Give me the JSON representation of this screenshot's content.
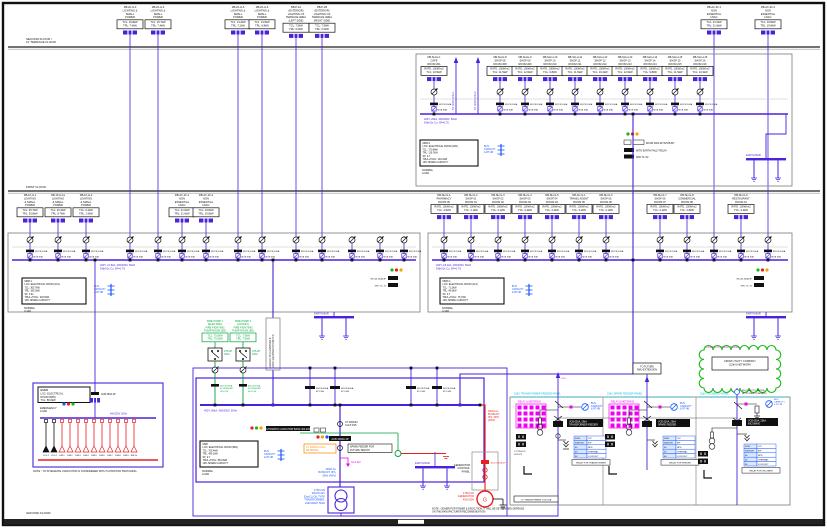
{
  "floors": {
    "second": [
      "SECOND FLOOR /",
      "1F TERRACE FLOOR"
    ],
    "first": [
      "FIRST FLOOR"
    ],
    "ground": [
      "GROUND FLOOR"
    ]
  },
  "shared": {
    "normal_load": [
      "NORMAL",
      "LOAD"
    ],
    "emergency_load": [
      "EMERGENCY",
      "LOAD"
    ],
    "capacity": [
      "BUS",
      "CAPACITY",
      "& RT-4B"
    ],
    "earth_bar": "EARTH BAR",
    "mcb_label": "MCB 63A",
    "chip_label": "MCCB 100A",
    "pilot": "R-Y-B"
  },
  "top_feeders": {
    "items": [
      {
        "x": 130,
        "lines": [
          "DB-2F-H-3",
          "LIGHTING &",
          "SMALL",
          "POWER"
        ],
        "box": [
          "TCL: 16.8kW",
          "TRL: 7.4kW"
        ]
      },
      {
        "x": 158,
        "lines": [
          "DB-2F-H-4",
          "LIGHTING &",
          "SMALL",
          "POWER"
        ],
        "box": [
          "TCL: 15.7kW",
          "TRL: 7.4kW"
        ]
      },
      {
        "x": 238,
        "lines": [
          "DB-2F-H-5",
          "LIGHTING &",
          "SMALL",
          "POWER"
        ],
        "box": [
          "TCL: 14.2kW",
          "TRL: 7.1kW"
        ]
      },
      {
        "x": 262,
        "lines": [
          "DB-2F-H-6",
          "LIGHTING &",
          "SMALL",
          "POWER"
        ],
        "box": [
          "TCL: 13.6kW",
          "TRL: 6.8kW"
        ]
      },
      {
        "x": 296,
        "lines": [
          "DB-P-1A",
          "(EXTERIOR)",
          "LIGHTING OF",
          "TERRACE AREA",
          "(LEFT SIDE)"
        ],
        "box": [
          "TCL: 7.5kW",
          "TRL: 6.0kW"
        ]
      },
      {
        "x": 322,
        "lines": [
          "DB-P-1B",
          "(EXTERIOR)",
          "LIGHTING OF",
          "TERRACE AREA",
          "(RIGHT SIDE)"
        ],
        "box": [
          "TCL: 7.5kW",
          "TRL: 6.0kW"
        ]
      },
      {
        "x": 714,
        "lines": [
          "DB-AC-2F-1",
          "NON",
          "ESSENTIAL",
          "HVAC"
        ],
        "box": [
          "TCL: 21.6kW",
          "TRL: 21.6kW"
        ]
      },
      {
        "x": 768,
        "lines": [
          "DB-AC-2F-2",
          "NON",
          "ESSENTIAL",
          "HVAC"
        ],
        "box": [
          "TCL: 19.8kW",
          "TRL: 19.8kW"
        ]
      }
    ]
  },
  "p2f": {
    "bus_note": [
      "400Y, 26kA, 400/230V, 50Hz",
      "63kA/1s Cu, SF=0.75"
    ],
    "info": [
      "MDB-2",
      "LOC: ELECTRICAL ROOM (206)",
      "TCL: 170.8kW",
      "TRL: 119.7kW",
      "SF: 0.7",
      "TRUL+TDCL: 149.2kW",
      "10% SPARE CAPACITY"
    ],
    "risers": [
      {
        "x": 456,
        "label": "TO ROOF AHU-1"
      },
      {
        "x": 478,
        "label": "TO ROOF AHU-2"
      }
    ],
    "notes": [
      "MCCB 400A 4P W/SHUNT",
      "WITH EARTH FAULT RELAY",
      "SPD T1+T2"
    ],
    "circuits": [
      {
        "x": 434,
        "lines": [
          "DB-SH-H-1",
          "CAFE",
          "ROOM 201"
        ],
        "box": [
          "RATE: 100W/m2",
          "TCL: 10.5kW"
        ]
      },
      {
        "x": 500,
        "lines": [
          "DB-SH-H-8",
          "SHOP 08",
          "ROOM 208"
        ],
        "box": [
          "RATE: 100W/m2",
          "TCL: 11.5kW"
        ]
      },
      {
        "x": 525,
        "lines": [
          "DB-SH-H-9",
          "SHOP 09",
          "ROOM 209"
        ],
        "box": [
          "RATE: 100W/m2",
          "TCL: 12.6kW"
        ]
      },
      {
        "x": 550,
        "lines": [
          "DB-SH-H-10",
          "SHOP 10",
          "ROOM 210"
        ],
        "box": [
          "RATE: 100W/m2",
          "TCL: 9.8kW"
        ]
      },
      {
        "x": 575,
        "lines": [
          "DB-SH-H-11",
          "SHOP 11",
          "ROOM 211"
        ],
        "box": [
          "RATE: 100W/m2",
          "TCL: 11.5kW"
        ]
      },
      {
        "x": 600,
        "lines": [
          "DB-SH-H-12",
          "SHOP 12",
          "ROOM 212"
        ],
        "box": [
          "RATE: 100W/m2",
          "TCL: 10.2kW"
        ]
      },
      {
        "x": 625,
        "lines": [
          "DB-SH-H-13",
          "SHOP 13",
          "ROOM 213"
        ],
        "box": [
          "RATE: 100W/m2",
          "TCL: 12.6kW"
        ]
      },
      {
        "x": 650,
        "lines": [
          "DB-SH-H-14",
          "SHOP 14",
          "ROOM 214"
        ],
        "box": [
          "RATE: 100W/m2",
          "TCL: 9.8kW"
        ]
      },
      {
        "x": 675,
        "lines": [
          "DB-SH-H-15",
          "SHOP 15",
          "ROOM 215"
        ],
        "box": [
          "RATE: 100W/m2",
          "TCL: 11.5kW"
        ]
      },
      {
        "x": 700,
        "lines": [
          "DB-SH-H-16",
          "SHOP 16",
          "ROOM 216"
        ],
        "box": [
          "RATE: 100W/m2",
          "TCL: 13.4kW"
        ]
      }
    ]
  },
  "p1fl": {
    "bus_note": [
      "400Y, 21.5kA, 400/230V, 50Hz",
      "63kA/1s Cu, SF=0.7S"
    ],
    "info": [
      "MDB-1",
      "LOC: ELECTRICAL ROOM (101)",
      "TCL: 305.7kW",
      "TRL: 185.3kW",
      "SF: 0.61",
      "TRUL+TDCL: 203.5kW",
      "10% SPARE CAPACITY"
    ],
    "notes": [
      "MCCB 400A 4P",
      "SPD T1+T2"
    ],
    "circuits": [
      {
        "x": 30,
        "lines": [
          "DB-1F-H-1",
          "LIGHTING",
          "& SMALL",
          "POWER"
        ],
        "box": [
          "TCL: 35.7kW",
          "TRL: 30.8kW"
        ]
      },
      {
        "x": 58,
        "lines": [
          "DB-1F-H-1a",
          "LIGHTING",
          "& SMALL",
          "POWER"
        ],
        "box": [
          "TCL: 26.3kW",
          "TRL: 8.7kW"
        ]
      },
      {
        "x": 86,
        "lines": [
          "DB-1F-H-2",
          "LIGHTING",
          "& SMALL",
          "POWER"
        ],
        "box": [
          "TCL: 6.2kW",
          "TRL: 1.5kW"
        ]
      },
      {
        "x": 130,
        "start": 226
      },
      {
        "x": 158,
        "start": 226
      },
      {
        "x": 182,
        "lines": [
          "DB-AC-1F-1",
          "NON",
          "ESSENTIAL",
          "HVAC"
        ],
        "box": [
          "TCL: 21.6kW",
          "TRL: 21.6kW"
        ]
      },
      {
        "x": 206,
        "lines": [
          "DB-AC-1F-2",
          "NON",
          "ESSENTIAL",
          "HVAC"
        ],
        "box": [
          "TCL: 19.8kW",
          "TRL: 19.8kW"
        ]
      },
      {
        "x": 238,
        "start": 226
      },
      {
        "x": 262,
        "start": 226
      },
      {
        "x": 296,
        "start": 226
      },
      {
        "x": 322,
        "start": 226
      },
      {
        "x": 352,
        "start": 236
      },
      {
        "x": 380,
        "start": 236
      },
      {
        "x": 404,
        "start": 236
      }
    ]
  },
  "p1fr": {
    "bus_note": [
      "400Y, 18.1kA, 400/230V, 50Hz",
      "63kA/1s Cu, SF=0.7S"
    ],
    "info": [
      "MDB-G",
      "LOC: ELECTRICAL ROOM (113)",
      "TCL: 71.3kW",
      "TRL: 49.9kW",
      "SF: 0.7",
      "TRUL+TDCL: 76.7kW",
      "10% SPARE CAPACITY"
    ],
    "notes": [
      "MCCB 400A 4P",
      "SPD T1+T2"
    ],
    "circuits": [
      {
        "x": 444,
        "lines": [
          "DB-SH-G-1",
          "PHARMACY",
          "ROOM 09"
        ],
        "box": [
          "RATE: 100W/m2",
          "TCL: 2.5kW"
        ]
      },
      {
        "x": 471,
        "lines": [
          "DB-SH-G-2",
          "SHOP 01",
          "ROOM 01"
        ],
        "box": [
          "RATE: 100W/m2",
          "TCL: 2.1kW"
        ]
      },
      {
        "x": 498,
        "lines": [
          "DB-SH-G-3",
          "SHOP 02",
          "ROOM 02"
        ],
        "box": [
          "RATE: 100W/m2",
          "TCL: 2.1kW"
        ]
      },
      {
        "x": 525,
        "lines": [
          "DB-SH-G-4",
          "SHOP 03",
          "ROOM 03"
        ],
        "box": [
          "RATE: 100W/m2",
          "TCL: 2.4kW"
        ]
      },
      {
        "x": 552,
        "lines": [
          "DB-SH-G-5",
          "SHOP 04",
          "ROOM 04"
        ],
        "box": [
          "RATE: 100W/m2",
          "TCL: 2.4kW"
        ]
      },
      {
        "x": 579,
        "lines": [
          "DB-AC-G-1",
          "TRAVEL AGENT",
          "ROOM 05"
        ],
        "box": [
          "RATE: 100W/m2",
          "TCL: 3.2kW"
        ]
      },
      {
        "x": 606,
        "lines": [
          "DB-SH-G-6",
          "SHOP 05",
          "ROOM 06"
        ],
        "box": [
          "RATE: 100W/m2",
          "TCL: 2.1kW"
        ]
      },
      {
        "x": 660,
        "lines": [
          "DB-SH-G-7",
          "SHOP 06",
          "ROOM 07"
        ],
        "box": [
          "RATE: 100W/m2",
          "TCL: 2.1kW"
        ]
      },
      {
        "x": 687,
        "lines": [
          "DB-SH-G-8",
          "COMMERCIAL",
          "ROOM 08"
        ],
        "box": [
          "RATE: 100W/m2",
          "TCL: 2.8kW"
        ]
      },
      {
        "x": 741,
        "lines": [
          "DB-SH-G-9",
          "RESTAURANT",
          "ROOM 10"
        ],
        "box": [
          "RATE: 100W/m2",
          "TCL: 3.4kW"
        ]
      },
      {
        "x": 714,
        "start": 226
      },
      {
        "x": 768,
        "start": 226
      }
    ]
  },
  "emdb": {
    "info": [
      "EMDB",
      "LOC: ELECTRICAL",
      "ROOM (B05)",
      "TCL: 86.6kW"
    ],
    "entry": "ACB 250A 4P",
    "bus_note": "400/230V, 50Hz",
    "note": "NOTE : TO INTEGRATE CAPACITOR IS CONSIDERED WITH THYRISTOR SWITCHING.",
    "branches": [
      {
        "x": 46,
        "label": "LTG-1",
        "color": "black"
      },
      {
        "x": 54,
        "label": "LTG-2",
        "color": "black"
      },
      {
        "x": 62,
        "label": "EM-1",
        "color": "red"
      },
      {
        "x": 70,
        "label": "EM-2",
        "color": "red"
      },
      {
        "x": 78,
        "label": "EM-3",
        "color": "red"
      },
      {
        "x": 86,
        "label": "EM-4",
        "color": "red"
      },
      {
        "x": 94,
        "label": "EM-5",
        "color": "red"
      },
      {
        "x": 102,
        "label": "EM-6",
        "color": "red"
      },
      {
        "x": 110,
        "label": "EM-7",
        "color": "red"
      },
      {
        "x": 118,
        "label": "EM-8",
        "color": "red"
      },
      {
        "x": 126,
        "label": "EM-9",
        "color": "red"
      },
      {
        "x": 134,
        "label": "EM-10",
        "color": "red"
      }
    ]
  },
  "msb": {
    "bus_note": "400Y, 65kA, 400/230V, 50Hz",
    "info": [
      "MSB",
      "LOC: ELECTRICAL ROOM (B01)",
      "TCL: 705.4kW",
      "TRL: 495.1kW",
      "SF: 0.7",
      "TRUL+TDCL: 581.8kW",
      "10% SPARE CAPACITY"
    ],
    "capbank": "AUTOMATIC CAPACITOR BANK 400 kVAr",
    "shaft_label": [
      "FEEDER TO ELEVATORS &",
      "ROOF EQUIPMENT (SHAFT 2)"
    ],
    "upfeeders": [
      {
        "x": 310,
        "label": [
          "MCCB 400A",
          "4P LSIG"
        ]
      },
      {
        "x": 335,
        "label": [
          "MCCB 400A",
          "4P LSIG"
        ]
      },
      {
        "x": 411,
        "label": [
          "MCCB 250A",
          "4P LSIG"
        ]
      },
      {
        "x": 437,
        "label": [
          "MCCB 250A",
          "4P LSIG"
        ]
      }
    ],
    "incomer": {
      "ct1": [
        "CT 2000/5A",
        "CL0.5 FS5"
      ],
      "acb": "ACB 4000A 4P",
      "ct2": [
        "CT 2000/5A CL0.2",
        "METERING"
      ],
      "spd": "SA 0.4kV",
      "busduct": [
        "3000A Cu",
        "BUSDUCT, 3Ph,",
        "50Hz (400V)"
      ]
    },
    "spare_box": [
      "SPARE FEEDER FOR",
      "FUTURE TENANT"
    ],
    "pumps": [
      {
        "x": 215,
        "lines": [
          "FIRE PUMP 1",
          "(ELECTRIC)",
          "FIRE FIGHTING",
          "PUMP ROOM (B2)"
        ],
        "box": [
          "TCL: 75.0kW",
          "TRL: 75.0kW"
        ]
      },
      {
        "x": 243,
        "lines": [
          "FIRE PUMP 2",
          "(JOCKEY)",
          "FIRE FIGHTING",
          "PUMP ROOM (B2)"
        ],
        "box": [
          "TCL: 7.5kW",
          "TRL: 7.5kW"
        ]
      }
    ],
    "ats_label": [
      "ATS 2P",
      "100A"
    ],
    "pump_chip": [
      "MCCB 200A",
      "4P W/SHUNT",
      "SF-0.3S"
    ]
  },
  "transformer": {
    "label": [
      "1750 kVA",
      "22kV/0.4kV",
      "(Dyn11) OIL TYPE",
      "TRANSFORMER,",
      "22kV/400V, 50Hz"
    ]
  },
  "generator": {
    "panel": [
      "GENERATOR",
      "CONTROL",
      "PANEL"
    ],
    "gen": [
      "1750 kVA",
      "GENERATOR",
      "400/230V"
    ],
    "busduct": [
      "3000A Cu",
      "BUSDUCT,",
      "3Ph, 50Hz",
      "(400V)"
    ],
    "acb": "ACB 2500A 4P",
    "g": "G",
    "note": [
      "NOTE : GENERATOR POWER & EXECUTION, IT WILL BE DETERMINED DEPENDS",
      "ON THE MANUFACTURER RECOMMENDATION."
    ]
  },
  "mv": {
    "cubicle_titles": [
      "22kV TRANSFORMER FEEDER PANEL",
      "22kV SPARE FEEDER PANEL",
      "22kV INCOMING PANEL"
    ],
    "panel_tag": "RELAY & METERING",
    "utility_scope": "POWER COMPANY SCOPE",
    "cloud": [
      "FROM UTILITY COMPANY",
      "(22kV) NETWORK"
    ],
    "meter": [
      "ELECTRICITY METER",
      "(BY POWER COMPANY)"
    ],
    "future_box": [
      "TO FUTURE",
      "RMU EXTENSION"
    ],
    "riser_tag": "22kV",
    "vcb": [
      [
        "VCB 630A, 25kA",
        "TRANSFORMER FEEDER"
      ],
      [
        "VCB 630A, 25kA",
        "SPARE FEEDER"
      ],
      [
        "VCB 630A, 25kA",
        "INCOMING"
      ]
    ],
    "vt": [
      "VT 22kV/√3",
      "110V/√3"
    ],
    "table_rows": [
      [
        "50/51",
        "O/C"
      ],
      [
        "50N/51N",
        "E/F"
      ],
      [
        "46",
        "NPS"
      ],
      [
        "49",
        "THERMAL"
      ],
      [
        "86",
        "LOCKOUT"
      ]
    ],
    "table_captions": [
      "RELAY FOR TRANSFORMER",
      "RELAY FOR FEEDER",
      "RELAY FOR INCOMER"
    ],
    "bottom_tag": "TO TRANSFORMER 1750 kVA"
  }
}
